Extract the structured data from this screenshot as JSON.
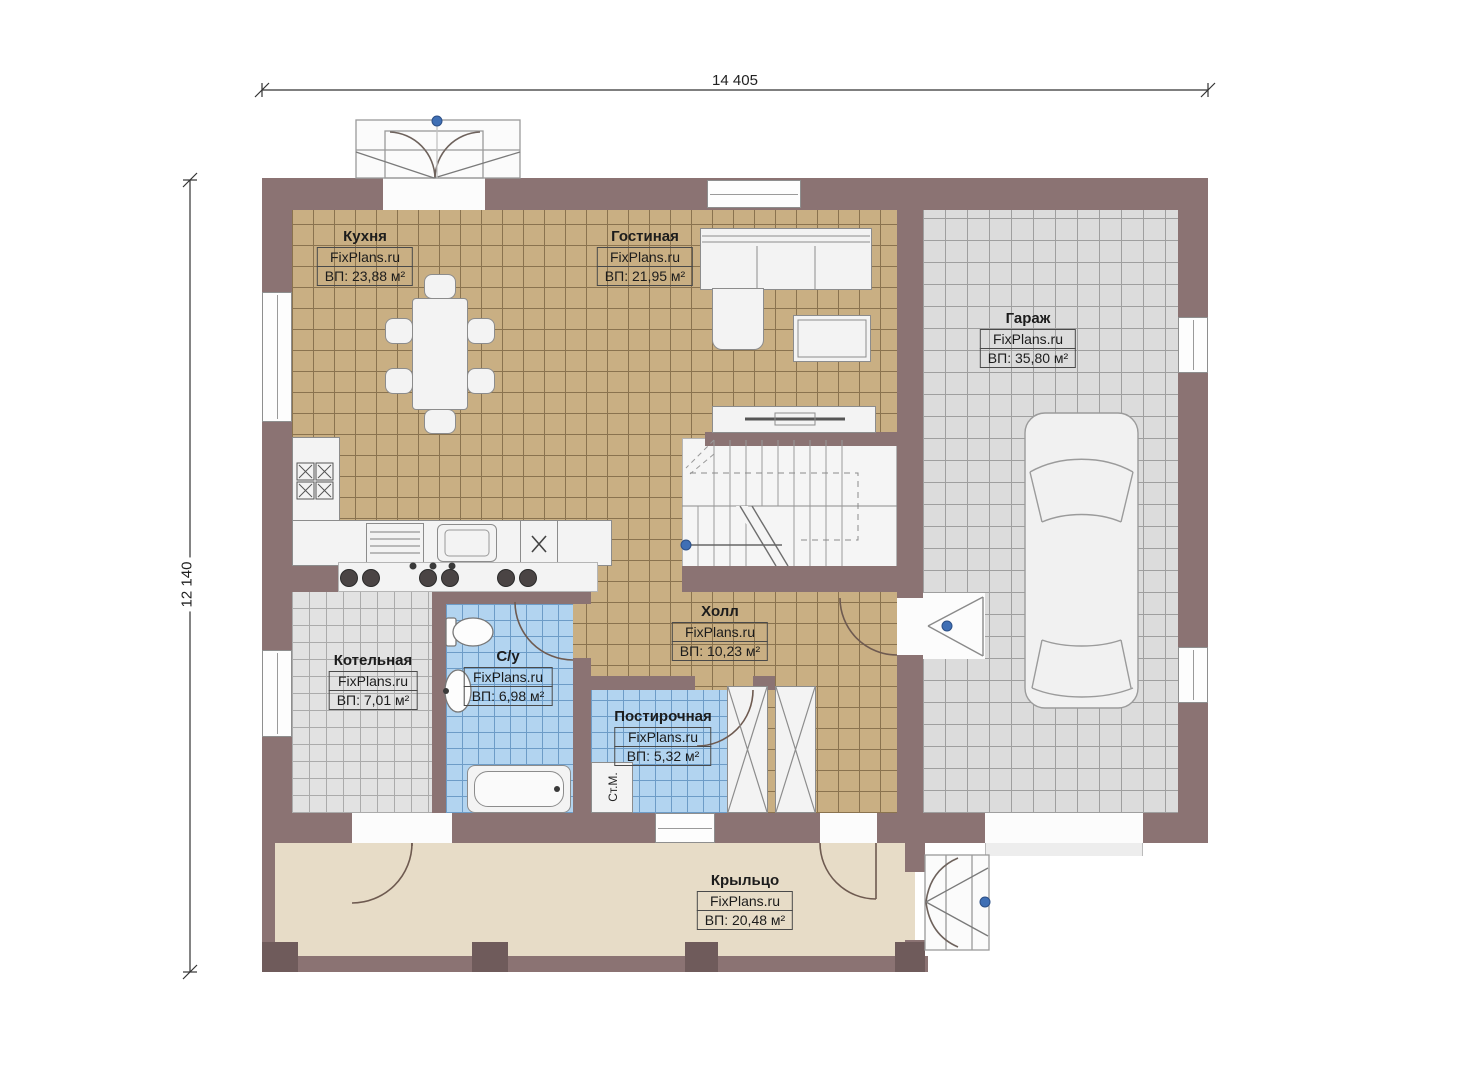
{
  "dimensions": {
    "top": "14 405",
    "left": "12 140"
  },
  "rooms": [
    {
      "id": "kitchen",
      "name": "Кухня",
      "brand": "FixPlans.ru",
      "area": "ВП: 23,88 м²"
    },
    {
      "id": "living",
      "name": "Гостиная",
      "brand": "FixPlans.ru",
      "area": "ВП: 21,95 м²"
    },
    {
      "id": "garage",
      "name": "Гараж",
      "brand": "FixPlans.ru",
      "area": "ВП: 35,80 м²"
    },
    {
      "id": "hall",
      "name": "Холл",
      "brand": "FixPlans.ru",
      "area": "ВП: 10,23 м²"
    },
    {
      "id": "boiler",
      "name": "Котельная",
      "brand": "FixPlans.ru",
      "area": "ВП: 7,01 м²"
    },
    {
      "id": "bathroom",
      "name": "С/у",
      "brand": "FixPlans.ru",
      "area": "ВП: 6,98 м²"
    },
    {
      "id": "laundry",
      "name": "Постирочная",
      "brand": "FixPlans.ru",
      "area": "ВП: 5,32 м²"
    },
    {
      "id": "porch",
      "name": "Крыльцо",
      "brand": "FixPlans.ru",
      "area": "ВП: 20,48 м²"
    }
  ],
  "labels": {
    "washing_machine": "Ст.М."
  },
  "colors": {
    "wall": "#8b7373",
    "wall-dark": "#6f5b5b",
    "floor-tan": "#c9af83",
    "grid-tan": "#8a734f",
    "floor-garage": "#dcdcdc",
    "grid-garage": "#9f9f9f",
    "floor-boiler": "#e2e2e2",
    "grid-boiler": "#ababab",
    "floor-blue": "#b2d4f0",
    "grid-blue": "#6d9cc7",
    "floor-porch": "#e7dcc7",
    "furniture": "#f3f3f3",
    "line": "#8c8c8c",
    "marker-blue": "#3f6fb5",
    "text": "#1c1c1c"
  }
}
